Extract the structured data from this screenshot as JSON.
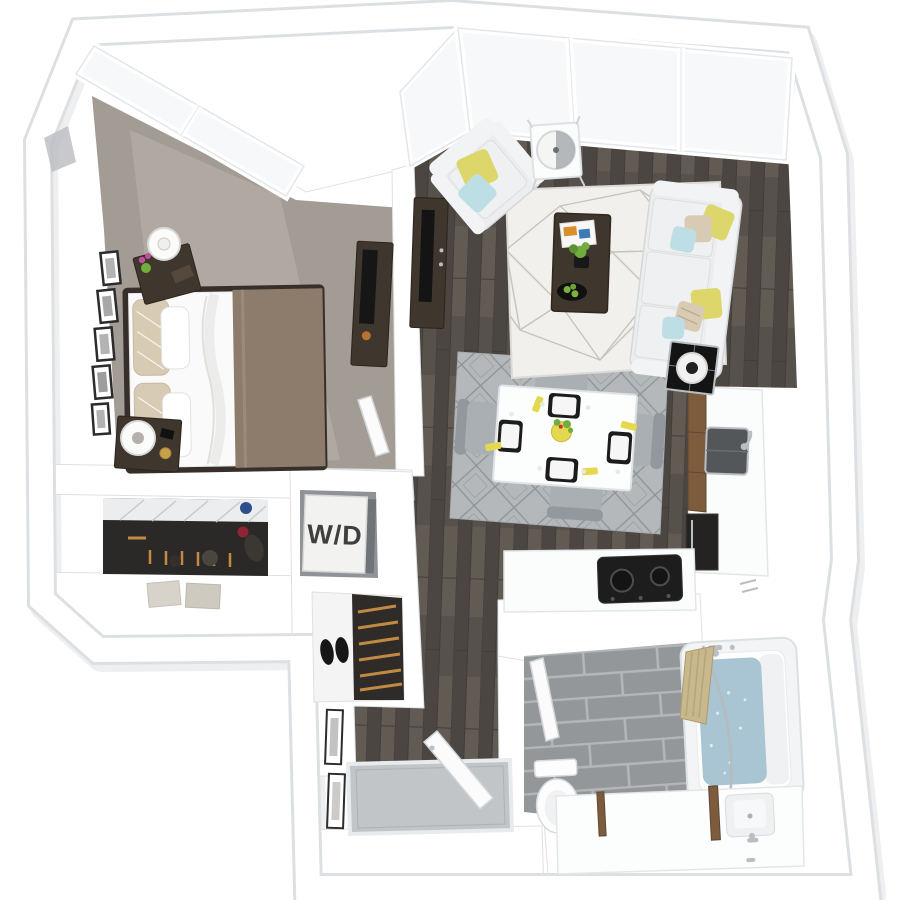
{
  "floorplan": {
    "view": "3D top-down one-bedroom apartment floor plan render",
    "label_wd": "W/D",
    "palette": {
      "wall": "#ffffff",
      "wall-edge": "#dde0e3",
      "wall-shadow": "#cdd0d4",
      "wall-face": "#b9bcc0",
      "glass": "#f6f8f9",
      "window-frame": "#e3e6e8",
      "wood-floor": "#57514c",
      "plank-dark": "#4b4641",
      "plank-light": "#615b54",
      "plank-seam": "#423d38",
      "carpet": "#a39c95",
      "carpet-light": "#bdb5ac",
      "area-rug": "#f1f0ed",
      "rug-line": "#c7c3bd",
      "dining-rug": "#b4b8ba",
      "dining-rug-line": "#8d9397",
      "tile": "#94979a",
      "tile-grout": "#b4b7ba",
      "upholstery": "#ebedee",
      "upholstery-edge": "#d5d8da",
      "cushion": "#eef0f1",
      "pillow-yellow": "#ddd66b",
      "pillow-blue": "#bedee5",
      "pillow-beige": "#d8cbb3",
      "wood-dark": "#3f362d",
      "wood-brown": "#7c5c3d",
      "blanket-taupe": "#8d7c6b",
      "appliance-black": "#1d1d1d",
      "water": "#a9c4d2",
      "shower-curtain": "#c9b88c",
      "chrome": "#b9bec3",
      "green": "#6fae3f",
      "napkin-yellow": "#e4d94e",
      "hanger-wood": "#c08a45",
      "closet-dark": "#2b2927",
      "box": "#d8d3ca",
      "entry-tile": "#c2c5c7",
      "shoe-black": "#161616",
      "frame-black": "#2c2c2c",
      "label-ink": "#3f3f3f"
    },
    "rooms": [
      {
        "id": "bedroom",
        "floor": "gray carpet",
        "features": [
          "angled corner window wall with 2 panes",
          "bed with white duvet and taupe blanket",
          "2 dark wood nightstands",
          "2 white drum table lamps",
          "pink flowers in green vase",
          "gallery of black picture frames",
          "dark dresser with television",
          "open door"
        ]
      },
      {
        "id": "living-room",
        "floor": "dark hardwood",
        "features": [
          "floor-to-ceiling corner windows",
          "white armchair with yellow and blue pillows",
          "white accent table with drum lamp",
          "white sofa with yellow, blue and patterned pillows",
          "white geometric area rug",
          "dark wood coffee table with magazine, plant and fruit bowl",
          "dark media console with television",
          "black glass side table with drum lamp"
        ]
      },
      {
        "id": "dining-area",
        "floor": "dark hardwood",
        "features": [
          "gray diamond-pattern rug",
          "white dining table",
          "4 gray chairs",
          "4 black placemats with white plates",
          "yellow napkins",
          "yellow bowl centerpiece with greenery"
        ]
      },
      {
        "id": "kitchen",
        "floor": "dark hardwood",
        "features": [
          "white counter along right wall",
          "wood cabinet fronts",
          "dark undermount sink with faucet",
          "tall dark appliance",
          "black cooktop with two burners",
          "white peninsula counter"
        ]
      },
      {
        "id": "bathroom",
        "floor": "gray tile",
        "features": [
          "bathtub filled with water",
          "tan shower curtain on curved rod",
          "white toilet",
          "white vanity with recessed sink and faucet",
          "wood framed mirror",
          "open door"
        ]
      },
      {
        "id": "walk-in-closet",
        "features": [
          "white wire shelf",
          "row of hangers",
          "shoes and bags on shelf",
          "duffel bag",
          "two storage boxes"
        ]
      },
      {
        "id": "laundry-closet",
        "features": [
          "stacked washer/dryer unit labeled W/D"
        ]
      },
      {
        "id": "entry",
        "floor": "dark hardwood",
        "features": [
          "recessed tile threshold",
          "open entry door",
          "slatted shoe rack",
          "pair of black shoes",
          "2 framed pictures"
        ]
      },
      {
        "id": "hallway",
        "floor": "dark hardwood",
        "features": [
          "connects living area, bedroom, bathroom and entry"
        ]
      }
    ]
  }
}
